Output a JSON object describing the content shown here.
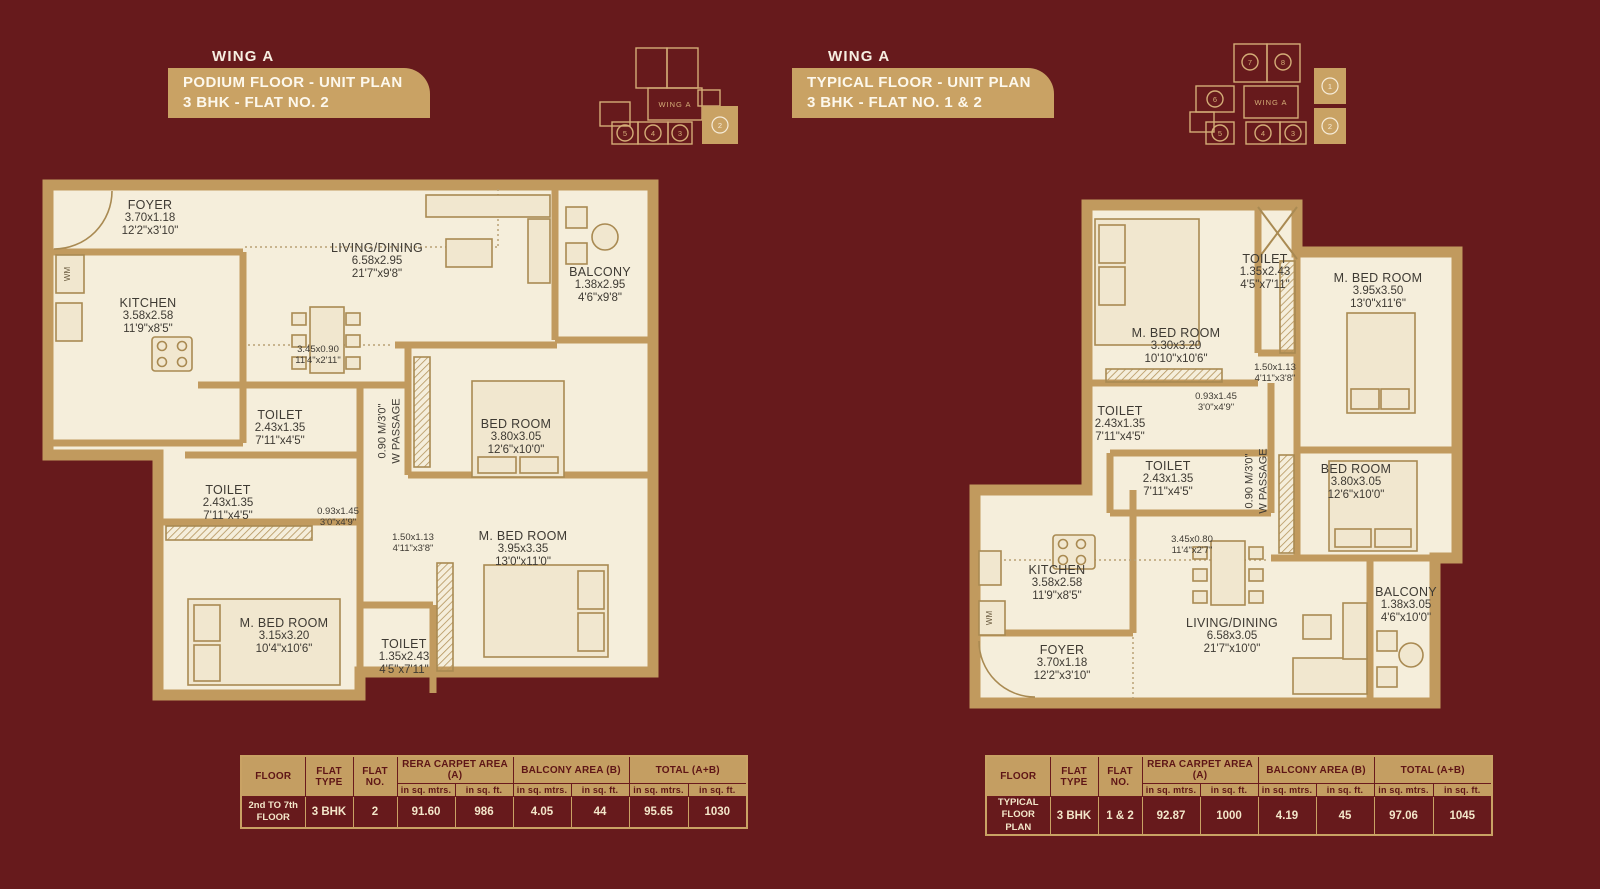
{
  "header_left": {
    "wing": "WING A",
    "banner_line1": "PODIUM FLOOR - UNIT PLAN",
    "banner_line2": "3 BHK - FLAT NO. 2"
  },
  "header_right": {
    "wing": "WING A",
    "banner_line1": "TYPICAL FLOOR - UNIT PLAN",
    "banner_line2": "3 BHK - FLAT NO. 1 & 2"
  },
  "keyplan_left": {
    "wing": "WING A",
    "unit_5": "5",
    "unit_4": "4",
    "unit_3": "3",
    "highlighted_unit_2": "2"
  },
  "keyplan_right": {
    "wing": "WING A",
    "unit_7": "7",
    "unit_8": "8",
    "unit_6": "6",
    "unit_5": "5",
    "unit_4": "4",
    "unit_3": "3",
    "highlighted_unit_1": "1",
    "highlighted_unit_2": "2"
  },
  "plan_left": {
    "wm": "WM",
    "rooms": [
      {
        "name": "FOYER",
        "m": "3.70x1.18",
        "ft": "12'2\"x3'10\""
      },
      {
        "name": "KITCHEN",
        "m": "3.58x2.58",
        "ft": "11'9\"x8'5\""
      },
      {
        "name": "LIVING/DINING",
        "m": "6.58x2.95",
        "ft": "21'7\"x9'8\""
      },
      {
        "name": "BALCONY",
        "m": "1.38x2.95",
        "ft": "4'6\"x9'8\""
      },
      {
        "name": "TOILET",
        "m": "2.43x1.35",
        "ft": "7'11\"x4'5\""
      },
      {
        "name": "BED ROOM",
        "m": "3.80x3.05",
        "ft": "12'6\"x10'0\""
      },
      {
        "name": "TOILET",
        "m": "2.43x1.35",
        "ft": "7'11\"x4'5\""
      },
      {
        "name": "M. BED ROOM",
        "m": "3.95x3.35",
        "ft": "13'0\"x11'0\""
      },
      {
        "name": "M. BED ROOM",
        "m": "3.15x3.20",
        "ft": "10'4\"x10'6\""
      },
      {
        "name": "TOILET",
        "m": "1.35x2.43",
        "ft": "4'5\"x7'11\""
      }
    ],
    "dims": [
      {
        "m": "3.45x0.90",
        "ft": "11'4\"x2'11\""
      },
      {
        "m": "0.93x1.45",
        "ft": "3'0\"x4'9\""
      },
      {
        "m": "1.50x1.13",
        "ft": "4'11\"x3'8\""
      }
    ],
    "passage_line1": "0.90 M/3'0\"",
    "passage_line2": "W PASSAGE"
  },
  "plan_right": {
    "wm": "WM",
    "rooms": [
      {
        "name": "M. BED ROOM",
        "m": "3.30x3.20",
        "ft": "10'10\"x10'6\""
      },
      {
        "name": "TOILET",
        "m": "1.35x2.43",
        "ft": "4'5\"x7'11\""
      },
      {
        "name": "M. BED ROOM",
        "m": "3.95x3.50",
        "ft": "13'0\"x11'6\""
      },
      {
        "name": "TOILET",
        "m": "2.43x1.35",
        "ft": "7'11\"x4'5\""
      },
      {
        "name": "TOILET",
        "m": "2.43x1.35",
        "ft": "7'11\"x4'5\""
      },
      {
        "name": "BED ROOM",
        "m": "3.80x3.05",
        "ft": "12'6\"x10'0\""
      },
      {
        "name": "KITCHEN",
        "m": "3.58x2.58",
        "ft": "11'9\"x8'5\""
      },
      {
        "name": "FOYER",
        "m": "3.70x1.18",
        "ft": "12'2\"x3'10\""
      },
      {
        "name": "LIVING/DINING",
        "m": "6.58x3.05",
        "ft": "21'7\"x10'0\""
      },
      {
        "name": "BALCONY",
        "m": "1.38x3.05",
        "ft": "4'6\"x10'0\""
      }
    ],
    "dims": [
      {
        "m": "0.93x1.45",
        "ft": "3'0\"x4'9\""
      },
      {
        "m": "1.50x1.13",
        "ft": "4'11\"x3'8\""
      },
      {
        "m": "3.45x0.80",
        "ft": "11'4\"x2'7\""
      }
    ],
    "passage_line1": "0.90 M/3'0\"",
    "passage_line2": "W PASSAGE"
  },
  "table_headers": {
    "floor": "FLOOR",
    "flat_type": "FLAT TYPE",
    "flat_no": "FLAT NO.",
    "rera": "RERA CARPET AREA (A)",
    "balcony": "BALCONY AREA (B)",
    "total": "TOTAL (A+B)",
    "sq_mtrs": "in sq. mtrs.",
    "sq_ft": "in sq. ft."
  },
  "table_left_row": {
    "floor_l1": "2nd TO 7th",
    "floor_l2": "FLOOR",
    "flat_type": "3 BHK",
    "flat_no": "2",
    "rera_m": "91.60",
    "rera_ft": "986",
    "balcony_m": "4.05",
    "balcony_ft": "44",
    "total_m": "95.65",
    "total_ft": "1030"
  },
  "table_right_row": {
    "floor_l1": "TYPICAL",
    "floor_l2": "FLOOR PLAN",
    "flat_type": "3 BHK",
    "flat_no": "1 & 2",
    "rera_m": "92.87",
    "rera_ft": "1000",
    "balcony_m": "4.19",
    "balcony_ft": "45",
    "total_m": "97.06",
    "total_ft": "1045"
  }
}
